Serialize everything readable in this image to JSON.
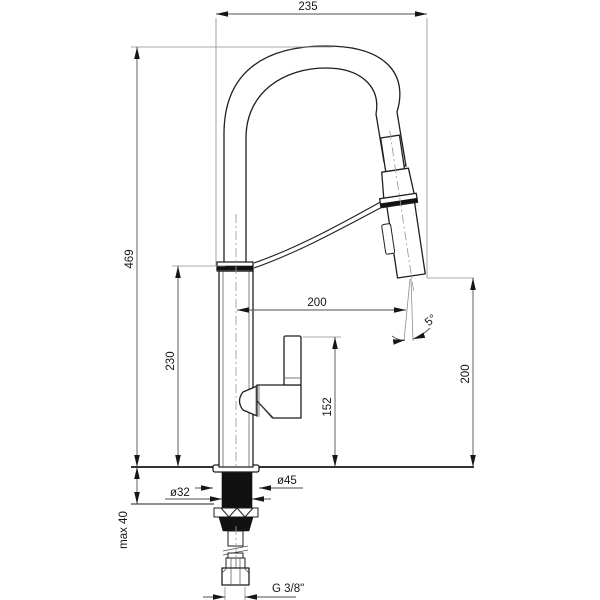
{
  "drawing": {
    "labels": {
      "width_top": "235",
      "height_total": "469",
      "height_body": "230",
      "reach_spout": "200",
      "height_handle": "152",
      "height_spray": "200",
      "angle_spray": "5°",
      "dia_hole": "ø32",
      "dia_base": "ø45",
      "max_thickness": "max 40",
      "thread": "G 3/8\""
    },
    "colors": {
      "line": "#1f1f1f",
      "dimension_line": "#4f4f4f",
      "extension_line": "#8d8d8d",
      "background": "#ffffff"
    }
  }
}
